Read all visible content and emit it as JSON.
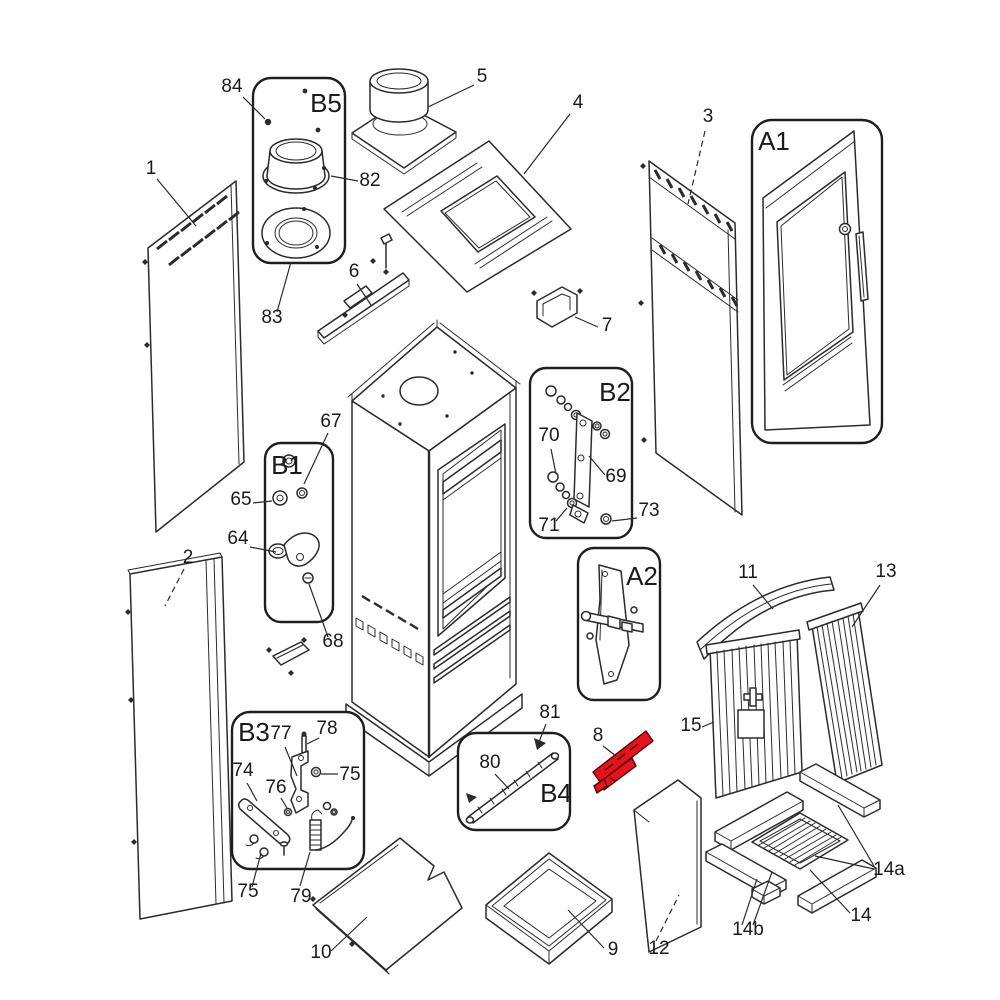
{
  "colors": {
    "background": "#ffffff",
    "line": "#2b2b2b",
    "highlight_red": "#e8121c"
  },
  "highlighted_part": "8",
  "parts": [
    "1",
    "2",
    "3",
    "4",
    "5",
    "6",
    "7",
    "8",
    "9",
    "10",
    "11",
    "12",
    "13",
    "14",
    "14a",
    "14b",
    "15"
  ],
  "assemblies": {
    "B5": [
      "82",
      "83",
      "84"
    ],
    "A1": [],
    "B1": [
      "64",
      "65",
      "67",
      "68"
    ],
    "B2": [
      "69",
      "70",
      "71",
      "73"
    ],
    "A2": [],
    "B3": [
      "74",
      "75",
      "76",
      "77",
      "78",
      "79"
    ],
    "B4": [
      "80",
      "81"
    ]
  },
  "labels": {
    "p1": "1",
    "p2": "2",
    "p3": "3",
    "p4": "4",
    "p5": "5",
    "p6": "6",
    "p7": "7",
    "p8": "8",
    "p9": "9",
    "p10": "10",
    "p11": "11",
    "p12": "12",
    "p13": "13",
    "p14": "14",
    "p14a": "14a",
    "p14b": "14b",
    "p15": "15",
    "p64": "64",
    "p65": "65",
    "p67": "67",
    "p68": "68",
    "p69": "69",
    "p70": "70",
    "p71": "71",
    "p73": "73",
    "p74": "74",
    "p75a": "75",
    "p75b": "75",
    "p76": "76",
    "p77": "77",
    "p78": "78",
    "p79": "79",
    "p80": "80",
    "p81": "81",
    "p82": "82",
    "p83": "83",
    "p84": "84",
    "gB5": "B5",
    "gA1": "A1",
    "gB1": "B1",
    "gB2": "B2",
    "gA2": "A2",
    "gB3": "B3",
    "gB4": "B4"
  }
}
